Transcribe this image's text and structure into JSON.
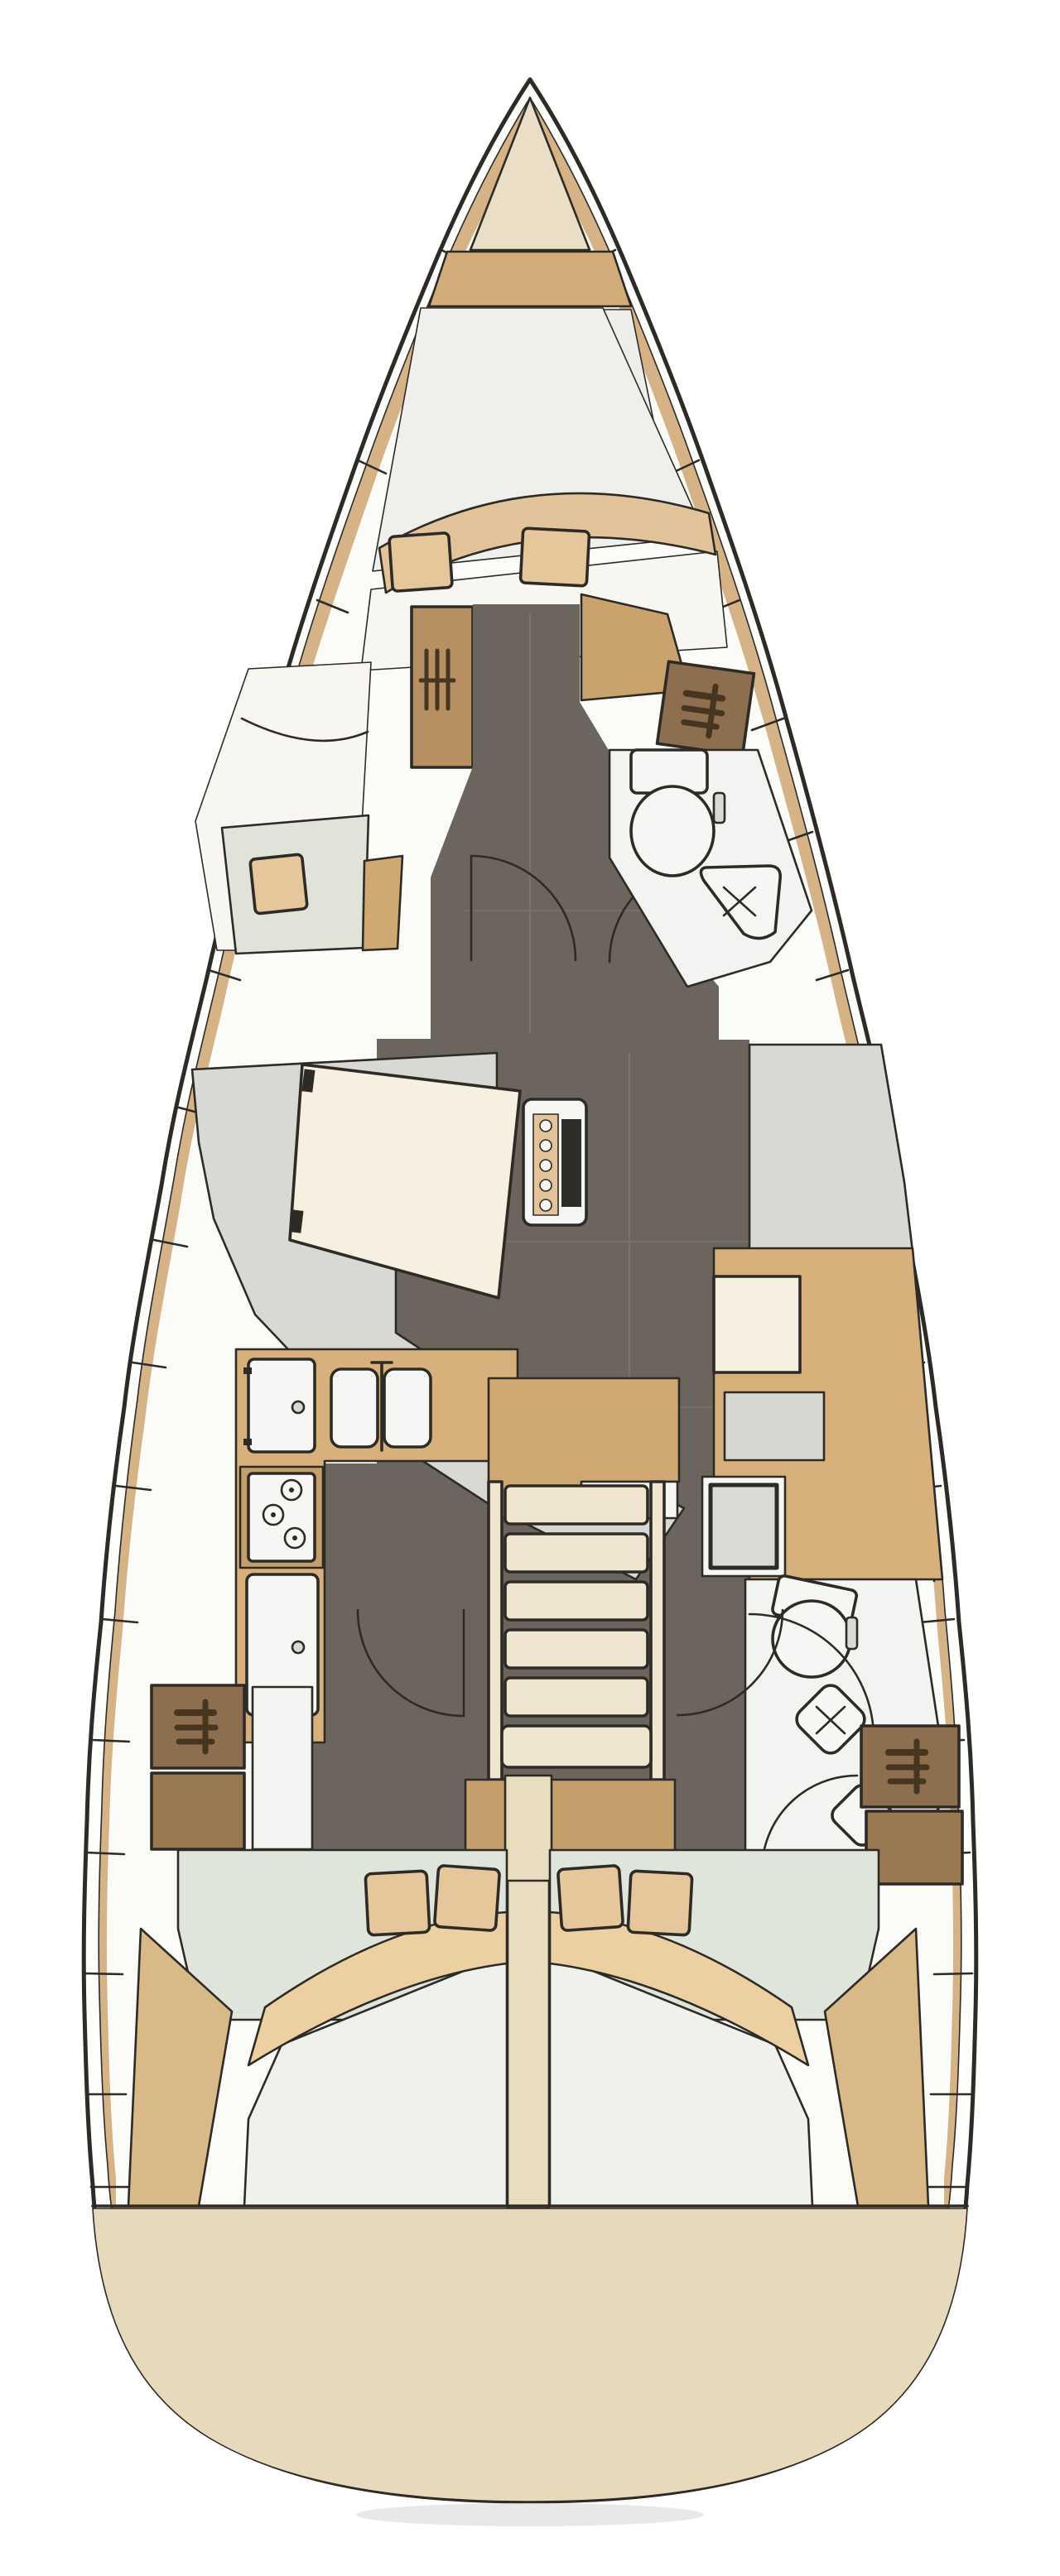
{
  "meta": {
    "title": "Sailing yacht interior layout — top-view deck plan",
    "orientation": "bow-up",
    "label": "Yacht floor plan diagram"
  },
  "colors": {
    "outline": "#2e2b26",
    "hullWhite": "#fdfdfc",
    "deckTan": "#d5b386",
    "interiorWhite": "#fbfbf8",
    "bowCream": "#eadfc6",
    "bowTan": "#d2ac79",
    "foredeckGrey": "#ededea",
    "berthWhite": "#efefeb",
    "sheetWhite": "#f8f6f1",
    "blanketTan": "#e3c49a",
    "pillowTan": "#e6c79c",
    "floorDark": "#6b655e",
    "floorSeam": "#8a8279",
    "seatGreen": "#dfe3d8",
    "deskTan": "#cfa873",
    "louverBrown": "#b78f63",
    "lockerBrown": "#8d6e4e",
    "lockerBrownLight": "#9a7852",
    "lockerTan": "#c9a26e",
    "headWhite": "#f3f3f1",
    "applianceWhite": "#f6f6f4",
    "settee": "#d8d8d5",
    "tableCream": "#f7efdf",
    "woodMid": "#c49e6b",
    "counterTan": "#d8b07c",
    "stepCream": "#f0e6d0",
    "dividerCream": "#e9ddc0",
    "navGrey": "#d6d6d3",
    "chartInner": "#d9d9d6",
    "greenFloor": "#dfe5db",
    "mattress": "#eff1ec",
    "wedgeTan": "#d9b988",
    "crescentTan": "#ecd0a2",
    "transomCream": "#e7d9bb",
    "shadow": "#dcdcda",
    "iconDark": "#46351f",
    "darkNotch": "#2f2d29"
  },
  "zones": {
    "hull": {
      "label": "Hull outline with side decks"
    },
    "anchorLocker": {
      "label": "Bow anchor locker"
    },
    "forwardCabin": {
      "label": "Forward cabin with V-berth, seat and lockers"
    },
    "forwardHead": {
      "label": "Forward head with toilet and corner sink"
    },
    "saloon": {
      "label": "Saloon with L-settee, dining table and starboard settee"
    },
    "galley": {
      "label": "Port galley with double sink, stove, oven and fridge"
    },
    "navStation": {
      "label": "Chart table and navigation seat"
    },
    "companionway": {
      "label": "Companionway steps over engine box"
    },
    "aftHead": {
      "label": "Aft head with toilet, sink and shower"
    },
    "aftCabinPort": {
      "label": "Aft double cabin, port side"
    },
    "aftCabinStarboard": {
      "label": "Aft double cabin, starboard side"
    },
    "transom": {
      "label": "Rounded stern transom"
    }
  },
  "counts": {
    "cabins": 3,
    "heads": 2,
    "toilets": 2,
    "berth_pillows_forward": 2,
    "seat_pillows_forward": 1,
    "berth_pillows_aft": 4,
    "companionway_steps": 6,
    "stove_burners": 3,
    "galley_sink_basins": 2,
    "shelf_locker_icons": 3,
    "louver_locker_icons": 1
  }
}
